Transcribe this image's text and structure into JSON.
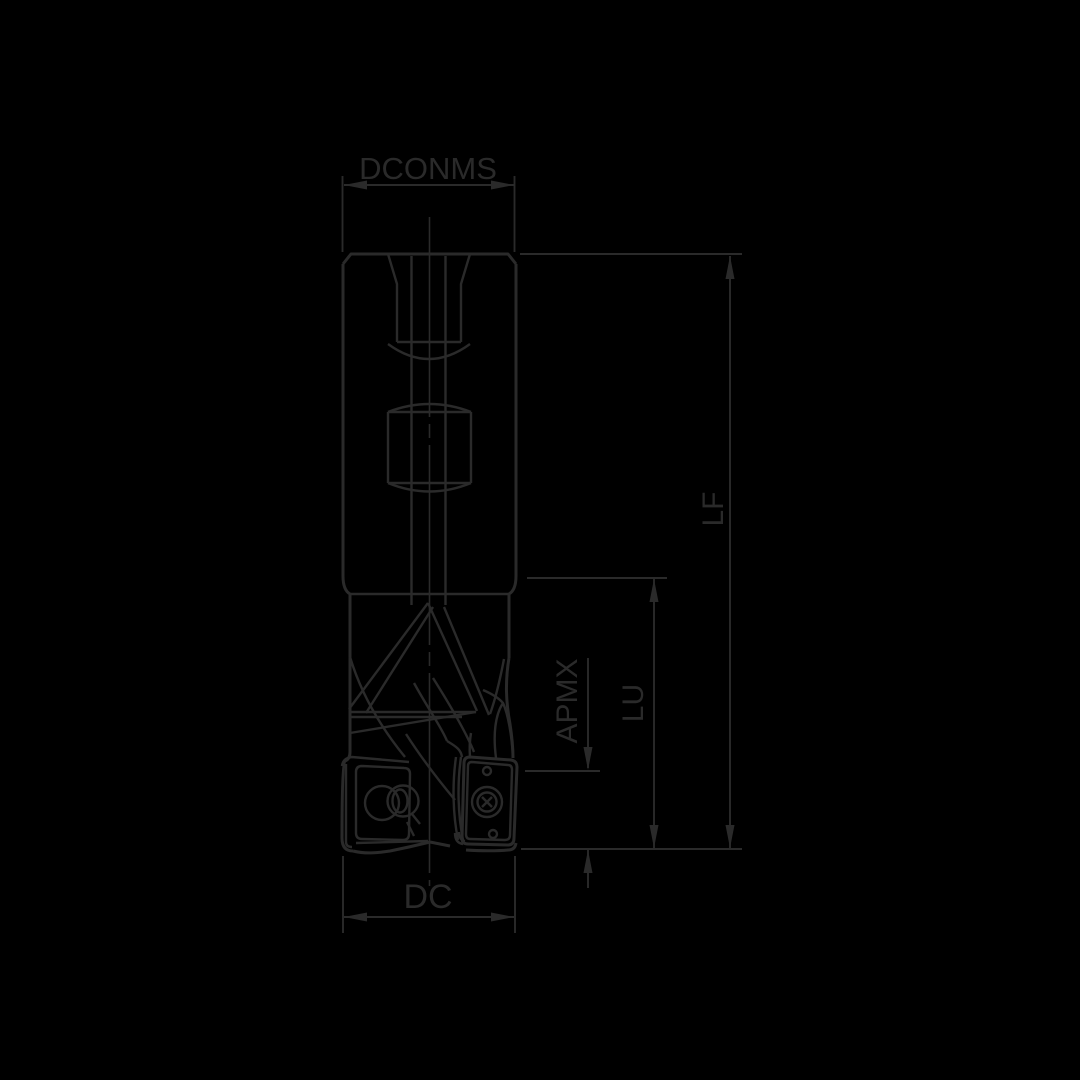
{
  "drawing": {
    "type": "technical-dimension-drawing",
    "subject": "indexable-end-mill-side-view",
    "labels": {
      "dconms": "DCONMS",
      "lf": "LF",
      "lu": "LU",
      "apmx": "APMX",
      "dc": "DC"
    },
    "colors": {
      "background": "#000000",
      "line": "#2a2a2a"
    }
  }
}
